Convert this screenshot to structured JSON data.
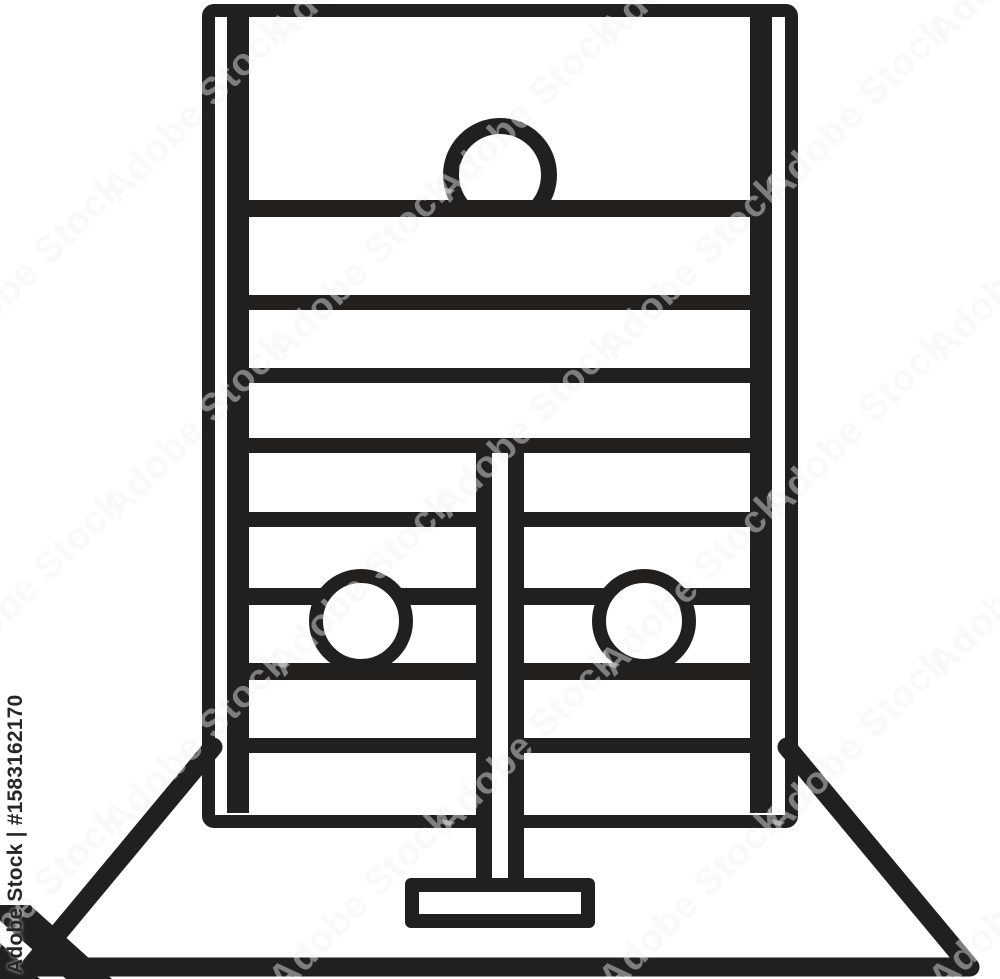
{
  "image": {
    "subject": "pillory-stocks-line-icon",
    "background_color": "#ffffff",
    "line_color": "#221f1f"
  },
  "watermark": {
    "brand": "Adobe Stock",
    "asset_id": "#1583162170",
    "side_text": "Adobe Stock | #1583162170",
    "tile_text": "Adobe Stock"
  }
}
